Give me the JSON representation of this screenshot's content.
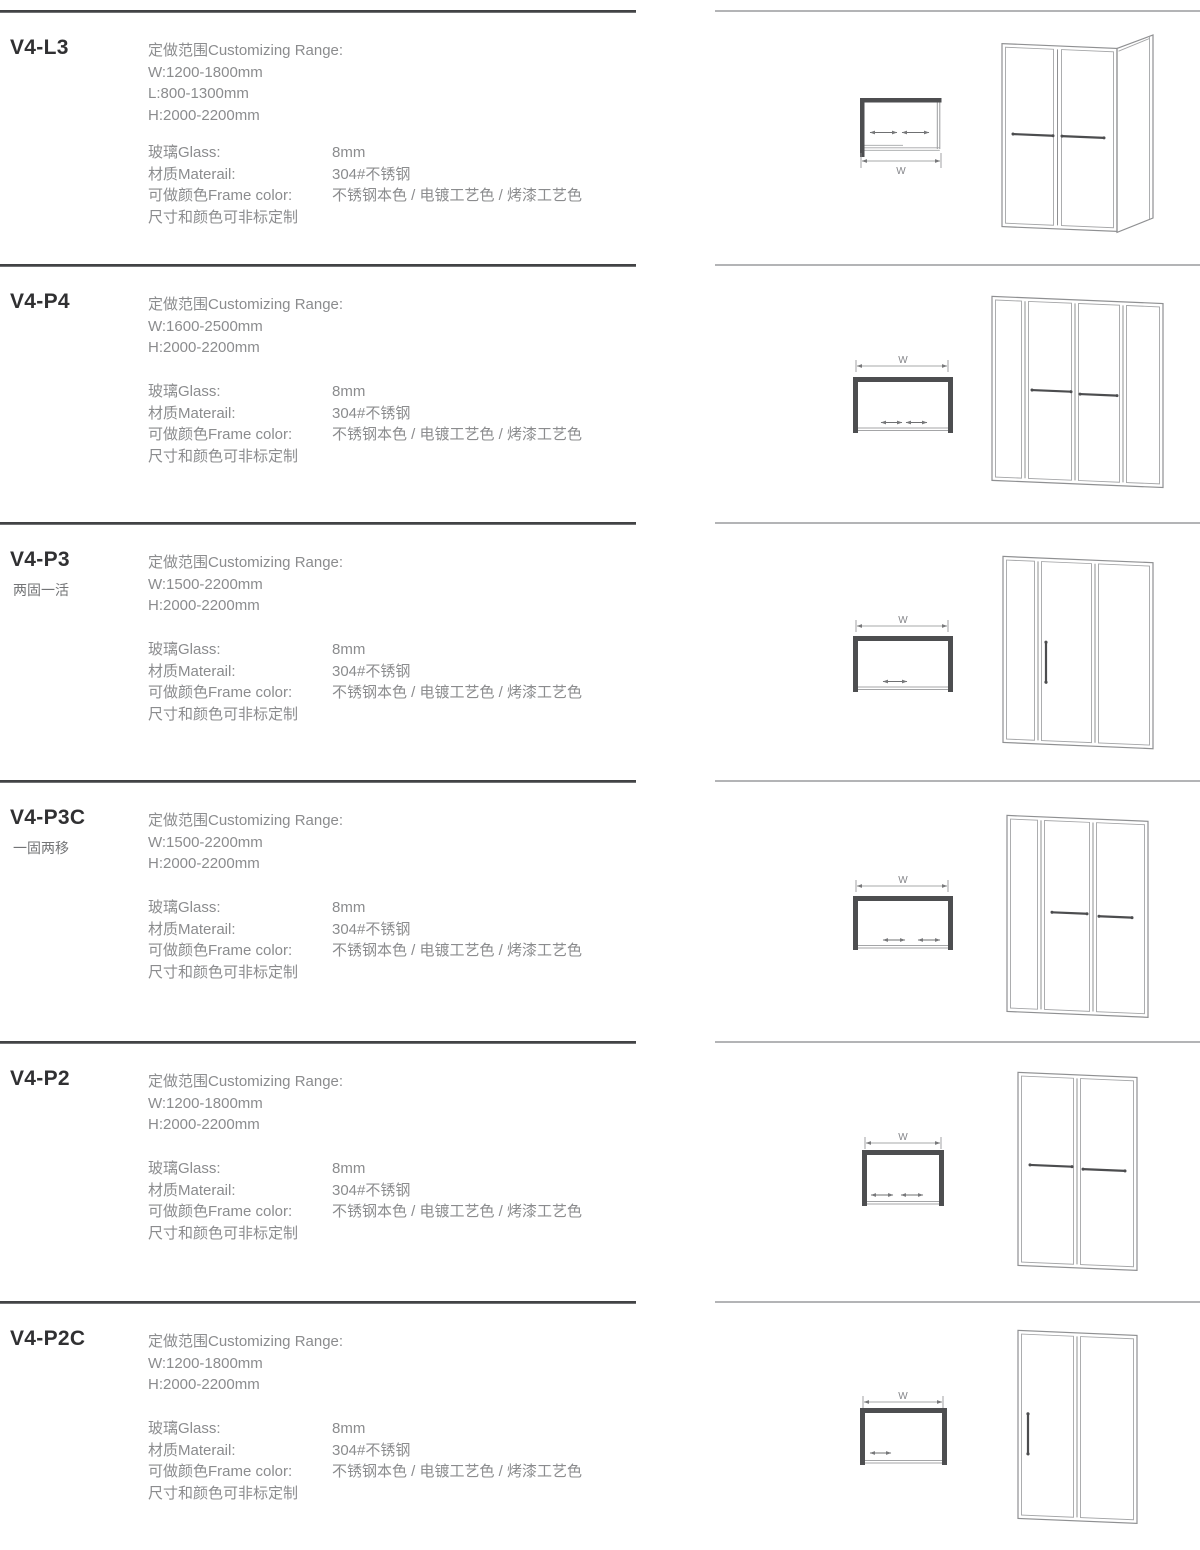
{
  "colors": {
    "divider_dark": "#4b4c4e",
    "divider_light": "#b3b4b6",
    "title_text": "#303032",
    "spec_text": "#8b8c8e",
    "drawing_wall": "#4d4e50",
    "drawing_line": "#9b9c9e",
    "handle": "#4c4d4f"
  },
  "sections": [
    {
      "model": "V4-L3",
      "subtitle": "",
      "range_label": "定做范围Customizing Range:",
      "dims": [
        "W:1200-1800mm",
        "L:800-1300mm",
        "H:2000-2200mm"
      ],
      "specs": [
        {
          "label": "玻璃Glass:",
          "value": "8mm"
        },
        {
          "label": "材质Materail:",
          "value": "304#不锈钢"
        },
        {
          "label": "可做颜色Frame color:",
          "value": "不锈钢本色 / 电镀工艺色 / 烤漆工艺色"
        },
        {
          "label": "尺寸和颜色可非标定制",
          "value": ""
        }
      ],
      "plan_label": "W"
    },
    {
      "model": "V4-P4",
      "subtitle": "",
      "range_label": "定做范围Customizing Range:",
      "dims": [
        "W:1600-2500mm",
        "H:2000-2200mm"
      ],
      "specs": [
        {
          "label": "玻璃Glass:",
          "value": "8mm"
        },
        {
          "label": "材质Materail:",
          "value": "304#不锈钢"
        },
        {
          "label": "可做颜色Frame color:",
          "value": "不锈钢本色 / 电镀工艺色 / 烤漆工艺色"
        },
        {
          "label": "尺寸和颜色可非标定制",
          "value": ""
        }
      ],
      "plan_label": "W"
    },
    {
      "model": "V4-P3",
      "subtitle": "两固一活",
      "range_label": "定做范围Customizing Range:",
      "dims": [
        "W:1500-2200mm",
        "H:2000-2200mm"
      ],
      "specs": [
        {
          "label": "玻璃Glass:",
          "value": "8mm"
        },
        {
          "label": "材质Materail:",
          "value": "304#不锈钢"
        },
        {
          "label": "可做颜色Frame color:",
          "value": "不锈钢本色 / 电镀工艺色 / 烤漆工艺色"
        },
        {
          "label": "尺寸和颜色可非标定制",
          "value": ""
        }
      ],
      "plan_label": "W"
    },
    {
      "model": "V4-P3C",
      "subtitle": "一固两移",
      "range_label": "定做范围Customizing Range:",
      "dims": [
        "W:1500-2200mm",
        "H:2000-2200mm"
      ],
      "specs": [
        {
          "label": "玻璃Glass:",
          "value": "8mm"
        },
        {
          "label": "材质Materail:",
          "value": "304#不锈钢"
        },
        {
          "label": "可做颜色Frame color:",
          "value": "不锈钢本色 / 电镀工艺色 / 烤漆工艺色"
        },
        {
          "label": "尺寸和颜色可非标定制",
          "value": ""
        }
      ],
      "plan_label": "W"
    },
    {
      "model": "V4-P2",
      "subtitle": "",
      "range_label": "定做范围Customizing Range:",
      "dims": [
        "W:1200-1800mm",
        "H:2000-2200mm"
      ],
      "specs": [
        {
          "label": "玻璃Glass:",
          "value": "8mm"
        },
        {
          "label": "材质Materail:",
          "value": "304#不锈钢"
        },
        {
          "label": "可做颜色Frame color:",
          "value": "不锈钢本色 / 电镀工艺色 / 烤漆工艺色"
        },
        {
          "label": "尺寸和颜色可非标定制",
          "value": ""
        }
      ],
      "plan_label": "W"
    },
    {
      "model": "V4-P2C",
      "subtitle": "",
      "range_label": "定做范围Customizing Range:",
      "dims": [
        "W:1200-1800mm",
        "H:2000-2200mm"
      ],
      "specs": [
        {
          "label": "玻璃Glass:",
          "value": "8mm"
        },
        {
          "label": "材质Materail:",
          "value": "304#不锈钢"
        },
        {
          "label": "可做颜色Frame color:",
          "value": "不锈钢本色 / 电镀工艺色 / 烤漆工艺色"
        },
        {
          "label": "尺寸和颜色可非标定制",
          "value": ""
        }
      ],
      "plan_label": "W"
    }
  ]
}
